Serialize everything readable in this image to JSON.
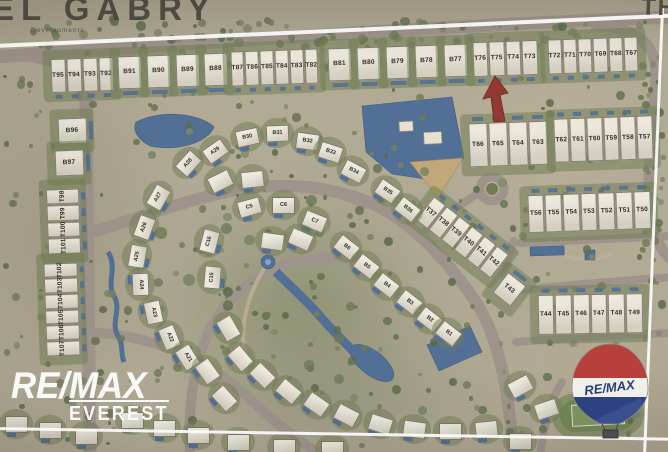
{
  "photo": {
    "brand_top": "EL GABRY",
    "brand_top_sub": "Developments",
    "corner_text": "TH"
  },
  "watermark": {
    "line1": "RE/MAX",
    "line2": "EVEREST"
  },
  "balloon": {
    "label": "RE/MAX"
  },
  "colors": {
    "water": "#4c6f9e",
    "roads": "#a2948a",
    "marker_arrow": "#a2332a",
    "balloon_red": "#cc3934",
    "balloon_blue": "#27408e"
  },
  "map": {
    "blocks": [
      {
        "labels": [
          "T95",
          "T94",
          "T93",
          "T92"
        ],
        "x": 50,
        "y": 58,
        "w": 64,
        "h": 34,
        "rot": -2,
        "pool": "bottom"
      },
      {
        "labels": [
          "B91"
        ],
        "x": 117,
        "y": 56,
        "w": 25,
        "h": 33,
        "rot": -2,
        "pool": "bottom"
      },
      {
        "labels": [
          "B90"
        ],
        "x": 146,
        "y": 55,
        "w": 25,
        "h": 33,
        "rot": -2,
        "pool": "bottom"
      },
      {
        "labels": [
          "B89"
        ],
        "x": 175,
        "y": 54,
        "w": 25,
        "h": 33,
        "rot": -2,
        "pool": "bottom"
      },
      {
        "labels": [
          "B88"
        ],
        "x": 203,
        "y": 53,
        "w": 25,
        "h": 33,
        "rot": -2,
        "pool": "bottom"
      },
      {
        "labels": [
          "T87",
          "T86",
          "T85",
          "T84",
          "T83",
          "T82"
        ],
        "x": 230,
        "y": 50,
        "w": 88,
        "h": 35,
        "rot": -2,
        "pool": "bottom"
      },
      {
        "labels": [
          "B81"
        ],
        "x": 327,
        "y": 48,
        "w": 25,
        "h": 33,
        "rot": -2,
        "pool": "bottom"
      },
      {
        "labels": [
          "B80"
        ],
        "x": 356,
        "y": 47,
        "w": 25,
        "h": 33,
        "rot": -2,
        "pool": "bottom"
      },
      {
        "labels": [
          "B79"
        ],
        "x": 385,
        "y": 46,
        "w": 25,
        "h": 33,
        "rot": -2,
        "pool": "bottom"
      },
      {
        "labels": [
          "B78"
        ],
        "x": 414,
        "y": 45,
        "w": 25,
        "h": 33,
        "rot": -2,
        "pool": "bottom"
      },
      {
        "labels": [
          "B77"
        ],
        "x": 443,
        "y": 44,
        "w": 25,
        "h": 33,
        "rot": -2,
        "pool": "bottom"
      },
      {
        "labels": [
          "T76",
          "T75",
          "T74",
          "T73"
        ],
        "x": 472,
        "y": 41,
        "w": 66,
        "h": 35,
        "rot": -2,
        "pool": "bottom"
      },
      {
        "labels": [
          "T72",
          "T71",
          "T70",
          "T69",
          "T68",
          "T67"
        ],
        "x": 547,
        "y": 38,
        "w": 92,
        "h": 35,
        "rot": -2,
        "pool": "bottom"
      },
      {
        "labels": [
          "T66",
          "T65",
          "T64",
          "T63"
        ],
        "x": 468,
        "y": 122,
        "w": 80,
        "h": 44,
        "rot": -2,
        "pool": "top"
      },
      {
        "labels": [
          "T62",
          "T61",
          "T60",
          "T59",
          "T58",
          "T57"
        ],
        "x": 553,
        "y": 117,
        "w": 100,
        "h": 44,
        "rot": -2,
        "pool": "top"
      },
      {
        "labels": [
          "T56",
          "T55",
          "T54",
          "T53",
          "T52",
          "T51",
          "T50"
        ],
        "x": 527,
        "y": 193,
        "w": 124,
        "h": 38,
        "rot": -2,
        "pool": "top"
      },
      {
        "labels": [
          "T44",
          "T45",
          "T46",
          "T47",
          "T48",
          "T49"
        ],
        "x": 537,
        "y": 294,
        "w": 106,
        "h": 40,
        "rot": -1,
        "pool": "top"
      },
      {
        "labels": [
          "T37",
          "T38",
          "T39",
          "T40",
          "T41",
          "T42"
        ],
        "x": 414,
        "y": 222,
        "w": 96,
        "h": 30,
        "rot": 38,
        "pool": "top"
      },
      {
        "labels": [
          "T43"
        ],
        "x": 497,
        "y": 276,
        "w": 24,
        "h": 26,
        "rot": 38,
        "pool": "top"
      },
      {
        "labels": [
          "B96"
        ],
        "x": 57,
        "y": 118,
        "w": 30,
        "h": 26,
        "rot": -2,
        "pool": "right"
      },
      {
        "labels": [
          "B97"
        ],
        "x": 54,
        "y": 150,
        "w": 30,
        "h": 26,
        "rot": -2,
        "pool": "right"
      },
      {
        "labels": [
          "T98",
          "T99",
          "T100",
          "T101"
        ],
        "x": 47,
        "y": 188,
        "w": 33,
        "h": 66,
        "rot": -2,
        "vertical": true,
        "pool": "right"
      },
      {
        "labels": [
          "T102",
          "T103",
          "T104",
          "T105",
          "T106",
          "T107"
        ],
        "x": 45,
        "y": 262,
        "w": 34,
        "h": 94,
        "rot": -2,
        "vertical": true,
        "pool": "right"
      }
    ],
    "villas": [
      {
        "label": "B30",
        "x": 247,
        "y": 137,
        "rot": -12
      },
      {
        "label": "B31",
        "x": 277,
        "y": 133,
        "rot": -2
      },
      {
        "label": "B32",
        "x": 307,
        "y": 141,
        "rot": 8
      },
      {
        "label": "B33",
        "x": 330,
        "y": 152,
        "rot": 18
      },
      {
        "label": "B34",
        "x": 353,
        "y": 171,
        "rot": 28
      },
      {
        "label": "B35",
        "x": 387,
        "y": 191,
        "rot": 34
      },
      {
        "label": "B36",
        "x": 407,
        "y": 209,
        "rot": 38
      },
      {
        "label": "C5",
        "x": 249,
        "y": 207,
        "rot": -15
      },
      {
        "label": "C6",
        "x": 283,
        "y": 205,
        "rot": 0
      },
      {
        "label": "C7",
        "x": 314,
        "y": 221,
        "rot": 22
      },
      {
        "label": "B6",
        "x": 346,
        "y": 247,
        "rot": 38
      },
      {
        "label": "B5",
        "x": 366,
        "y": 266,
        "rot": 38
      },
      {
        "label": "B4",
        "x": 386,
        "y": 285,
        "rot": 38
      },
      {
        "label": "B3",
        "x": 409,
        "y": 302,
        "rot": 38
      },
      {
        "label": "B2",
        "x": 429,
        "y": 319,
        "rot": 38
      },
      {
        "label": "B1",
        "x": 448,
        "y": 333,
        "rot": 38
      },
      {
        "label": "A29",
        "x": 215,
        "y": 151,
        "rot": -35
      },
      {
        "label": "A28",
        "x": 188,
        "y": 163,
        "rot": -48
      },
      {
        "label": "A27",
        "x": 158,
        "y": 197,
        "rot": -60
      },
      {
        "label": "A26",
        "x": 144,
        "y": 227,
        "rot": -70
      },
      {
        "label": "A25",
        "x": 137,
        "y": 256,
        "rot": -80
      },
      {
        "label": "A24",
        "x": 140,
        "y": 284,
        "rot": 88
      },
      {
        "label": "A23",
        "x": 153,
        "y": 312,
        "rot": 78
      },
      {
        "label": "A22",
        "x": 169,
        "y": 337,
        "rot": 68
      },
      {
        "label": "A21",
        "x": 187,
        "y": 357,
        "rot": 58
      },
      {
        "label": "C16",
        "x": 209,
        "y": 241,
        "rot": -75
      },
      {
        "label": "C15",
        "x": 212,
        "y": 277,
        "rot": -85
      }
    ],
    "filler_villas": [
      [
        240,
        358,
        50
      ],
      [
        262,
        375,
        45
      ],
      [
        288,
        391,
        40
      ],
      [
        316,
        404,
        35
      ],
      [
        346,
        415,
        28
      ],
      [
        380,
        424,
        18
      ],
      [
        414,
        429,
        8
      ],
      [
        450,
        431,
        0
      ],
      [
        486,
        429,
        -6
      ],
      [
        228,
        328,
        60
      ],
      [
        207,
        371,
        55
      ],
      [
        224,
        398,
        48
      ],
      [
        520,
        386,
        -28
      ],
      [
        546,
        409,
        -18
      ],
      [
        252,
        179,
        -6
      ],
      [
        220,
        181,
        -26
      ],
      [
        300,
        239,
        24
      ],
      [
        272,
        241,
        8
      ],
      [
        132,
        420,
        0
      ],
      [
        164,
        428,
        0
      ],
      [
        198,
        435,
        0
      ],
      [
        238,
        442,
        0
      ],
      [
        284,
        447,
        0
      ],
      [
        332,
        449,
        0
      ],
      [
        16,
        424,
        0
      ],
      [
        50,
        430,
        0
      ],
      [
        86,
        436,
        0
      ],
      [
        520,
        441,
        0
      ]
    ]
  }
}
